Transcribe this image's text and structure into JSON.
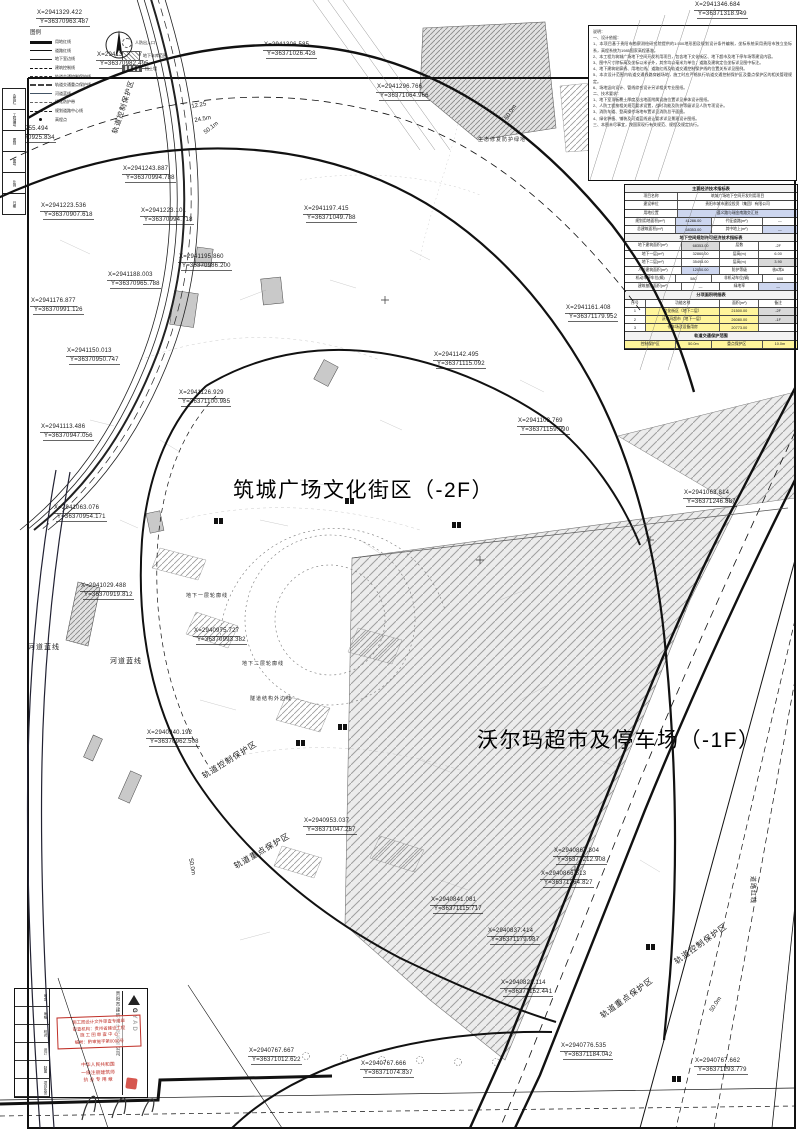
{
  "zones": {
    "zone1": "筑城广场文化街区（-2F）",
    "zone2": "沃尔玛超市及停车场（-1F）"
  },
  "compass_label": "北",
  "coord_labels": [
    {
      "x": 36,
      "y": 10,
      "l1": "X=2941329.422",
      "l2": "Y=36370963.487"
    },
    {
      "x": 96,
      "y": 52,
      "l1": "X=2941300.177",
      "l2": "Y=36370982.495"
    },
    {
      "x": 263,
      "y": 42,
      "l1": "X=2941306.585",
      "l2": "Y=36371026.428"
    },
    {
      "x": 376,
      "y": 84,
      "l1": "X=2941296.766",
      "l2": "Y=36371064.966"
    },
    {
      "x": 694,
      "y": 2,
      "l1": "X=2941346.684",
      "l2": "Y=36371318.949"
    },
    {
      "x": 2,
      "y": 126,
      "l1": "X=2941255.494",
      "l2": "Y=36370925.834"
    },
    {
      "x": 122,
      "y": 166,
      "l1": "X=2941243.887",
      "l2": "Y=36370994.788"
    },
    {
      "x": 40,
      "y": 203,
      "l1": "X=2941223.536",
      "l2": "Y=36370907.618"
    },
    {
      "x": 140,
      "y": 208,
      "l1": "X=2941223.101",
      "l2": "Y=36370994.718"
    },
    {
      "x": 303,
      "y": 206,
      "l1": "X=2941197.415",
      "l2": "Y=36371049.788"
    },
    {
      "x": 178,
      "y": 254,
      "l1": "X=2941195.860",
      "l2": "Y=36370986.200"
    },
    {
      "x": 107,
      "y": 272,
      "l1": "X=2941188.003",
      "l2": "Y=36370965.788"
    },
    {
      "x": 30,
      "y": 298,
      "l1": "X=2941176.877",
      "l2": "Y=36370991.126"
    },
    {
      "x": 66,
      "y": 348,
      "l1": "X=2941150.013",
      "l2": "Y=36370950.747"
    },
    {
      "x": 433,
      "y": 352,
      "l1": "X=2941142.495",
      "l2": "Y=36371115.092"
    },
    {
      "x": 178,
      "y": 390,
      "l1": "X=2941126.929",
      "l2": "Y=36371100.985"
    },
    {
      "x": 40,
      "y": 424,
      "l1": "X=2941113.486",
      "l2": "Y=36370947.056"
    },
    {
      "x": 565,
      "y": 305,
      "l1": "X=2941161.408",
      "l2": "Y=36371179.952"
    },
    {
      "x": 517,
      "y": 418,
      "l1": "X=2941103.769",
      "l2": "Y=36371159.990"
    },
    {
      "x": 683,
      "y": 490,
      "l1": "X=2941063.814",
      "l2": "Y=36371246.887"
    },
    {
      "x": 53,
      "y": 505,
      "l1": "X=2941063.076",
      "l2": "Y=36370954.171"
    },
    {
      "x": 80,
      "y": 583,
      "l1": "X=2941029.488",
      "l2": "Y=36370919.812"
    },
    {
      "x": 193,
      "y": 628,
      "l1": "X=2940975.727",
      "l2": "Y=36370993.382"
    },
    {
      "x": 146,
      "y": 730,
      "l1": "X=2940940.192",
      "l2": "Y=36370962.508"
    },
    {
      "x": 303,
      "y": 818,
      "l1": "X=2940953.037",
      "l2": "Y=36371047.257"
    },
    {
      "x": 553,
      "y": 848,
      "l1": "X=2940867.804",
      "l2": "Y=36371212.908"
    },
    {
      "x": 540,
      "y": 871,
      "l1": "X=2940866.513",
      "l2": "Y=36371264.827"
    },
    {
      "x": 430,
      "y": 897,
      "l1": "X=2940841.081",
      "l2": "Y=36371115.717"
    },
    {
      "x": 487,
      "y": 928,
      "l1": "X=2940837.414",
      "l2": "Y=36371179.987"
    },
    {
      "x": 500,
      "y": 980,
      "l1": "X=2940822.114",
      "l2": "Y=36371152.441"
    },
    {
      "x": 248,
      "y": 1048,
      "l1": "X=2940767.667",
      "l2": "Y=36371012.622"
    },
    {
      "x": 360,
      "y": 1061,
      "l1": "X=2940767.666",
      "l2": "Y=36371074.837"
    },
    {
      "x": 560,
      "y": 1043,
      "l1": "X=2940776.535",
      "l2": "Y=36371184.042"
    },
    {
      "x": 694,
      "y": 1058,
      "l1": "X=2940767.662",
      "l2": "Y=36371293.779"
    }
  ],
  "dim_labels": [
    {
      "t": "12.25",
      "x": 191,
      "y": 104,
      "rot": -10
    },
    {
      "t": "24.5m",
      "x": 194,
      "y": 118,
      "rot": -10
    },
    {
      "t": "50.1m",
      "x": 203,
      "y": 131,
      "rot": -38
    },
    {
      "t": "50.0m",
      "x": 504,
      "y": 118,
      "rot": -57
    },
    {
      "t": "50.0m",
      "x": 709,
      "y": 1010,
      "rot": -57
    },
    {
      "t": "50.0m",
      "x": 193,
      "y": 858,
      "rot": 80
    }
  ],
  "area_labels": [
    {
      "t": "轨道控制保护区",
      "x": 110,
      "y": 132,
      "rot": -72,
      "size": 7
    },
    {
      "t": "轨道控制保护区",
      "x": 200,
      "y": 772,
      "rot": -32
    },
    {
      "t": "轨道重点保护区",
      "x": 232,
      "y": 862,
      "rot": -30
    },
    {
      "t": "轨道控制保护区",
      "x": 672,
      "y": 958,
      "rot": -36
    },
    {
      "t": "轨道重点保护区",
      "x": 598,
      "y": 1012,
      "rot": -36
    },
    {
      "t": "河道蓝线",
      "x": 28,
      "y": 642,
      "size": 7
    },
    {
      "t": "河道蓝线",
      "x": 110,
      "y": 656,
      "size": 7
    },
    {
      "t": "地下一层轮廓线",
      "x": 186,
      "y": 592,
      "size": 5
    },
    {
      "t": "地下二层轮廓线",
      "x": 242,
      "y": 660,
      "size": 5
    },
    {
      "t": "隧道结构外边线",
      "x": 250,
      "y": 695,
      "size": 5
    },
    {
      "t": "生态修复防护绿地",
      "x": 478,
      "y": 136,
      "size": 5
    },
    {
      "t": "道路红线",
      "x": 758,
      "y": 876,
      "rot": 90,
      "size": 6
    }
  ],
  "legend": {
    "title": "图例",
    "items": [
      {
        "label": "用地红线",
        "kind": "thick"
      },
      {
        "label": "道路红线",
        "kind": "thin"
      },
      {
        "label": "地下室边线",
        "kind": "med"
      },
      {
        "label": "建筑控制线",
        "kind": "dash"
      },
      {
        "label": "轨道交通控制保护线",
        "kind": "dashdot"
      },
      {
        "label": "轨道交通重点保护线",
        "kind": "dashdot2"
      },
      {
        "label": "河道蓝线",
        "kind": "blue"
      },
      {
        "label": "绿化防护带",
        "kind": "dash2"
      },
      {
        "label": "规划道路中心线",
        "kind": "center"
      },
      {
        "label": "高程点",
        "kind": "dot"
      }
    ],
    "samples": [
      {
        "label": "人防出入口",
        "kind": "circle"
      },
      {
        "label": "地下车库范围",
        "kind": "hatch"
      },
      {
        "label": "挡土墙",
        "kind": "bar"
      }
    ]
  },
  "margin_labels": [
    "会签栏",
    "工程编号",
    "图别",
    "图号",
    "比例",
    "日期"
  ],
  "notes": {
    "lines": [
      "说明：",
      "一、设计依据：",
      "1、本项目基于贵阳市勘察测绘研究院提供的1:500地形图及规划设计条件编制，坐标系统采用贵阳市独立坐标系，高程系统为1985国家高程基准。",
      "2、本工程为筑城广场地下空间开发利用项目，包含地下文化街区、地下超市及地下停车场等建设内容。",
      "3、图中尺寸除标高及坐标以米计外，其余均以毫米为单位；道路及建筑定位坐标详见图中标注。",
      "4、地下建筑轮廓线、用地红线、道路红线及轨道交通控制保护线的位置关系详见图例。",
      "5、本次设计范围内轨道交通线路穿越场地，施工时应严格执行轨道交通控制保护区及重点保护区的相关管理规定。",
      "6、场地竖向设计、管线综合设计另详相关专业图纸。",
      "二、技术要求：",
      "1、地下室顶板覆土厚度及出地面附属设施位置详见单体设计图纸。",
      "2、人防工程按相关规范要求设置，战时功能及防护等级详见人防专项设计。",
      "3、消防车道、登高操作场地布置详见消防总平面图。",
      "4、绿化种植、铺装及河道蓝线退让要求详见景观设计图纸。",
      "三、本图未尽事宜，按国家现行有关规范、规程及规定执行。"
    ]
  },
  "table": {
    "rows": [
      {
        "h": "主要经济技术指标表"
      },
      {
        "cells": [
          {
            "t": "项目名称",
            "w": 3
          },
          {
            "t": "筑城广场地下空间开发利用项目",
            "w": 7
          }
        ]
      },
      {
        "cells": [
          {
            "t": "建设单位",
            "w": 3
          },
          {
            "t": "贵阳市城市建设投资（集团）有限公司",
            "w": 7
          }
        ]
      },
      {
        "cells": [
          {
            "t": "用地位置",
            "w": 3
          },
          {
            "t": "遵义路与瑞金南路交汇处",
            "w": 7,
            "bg": "#cdd6ef"
          }
        ]
      },
      {
        "cells": [
          {
            "t": "规划用地面积(m²)",
            "w": 3
          },
          {
            "t": "41286.00",
            "w": 2,
            "bg": "#cdd6ef"
          },
          {
            "t": "代征道路(m²)",
            "w": 3
          },
          {
            "t": "—",
            "w": 2
          }
        ]
      },
      {
        "cells": [
          {
            "t": "总建筑面积(m²)",
            "w": 3
          },
          {
            "t": "68353.00",
            "w": 2,
            "bg": "#cdd6ef"
          },
          {
            "t": "其中地上(m²)",
            "w": 3
          },
          {
            "t": "—",
            "w": 2,
            "bg": "#cdd6ef"
          }
        ]
      },
      {
        "h": "地下空间规划许可经济技术指标表"
      },
      {
        "cells": [
          {
            "t": "地下建筑面积(m²)",
            "w": 3
          },
          {
            "t": "68353.00",
            "w": 2,
            "bg": "#d9d9d9"
          },
          {
            "t": "层数",
            "w": 2
          },
          {
            "t": "-2F",
            "w": 2
          }
        ]
      },
      {
        "cells": [
          {
            "t": "地下一层(m²)",
            "w": 3
          },
          {
            "t": "32860.00",
            "w": 2
          },
          {
            "t": "层高(m)",
            "w": 2
          },
          {
            "t": "6.00",
            "w": 2
          }
        ]
      },
      {
        "cells": [
          {
            "t": "地下二层(m²)",
            "w": 3
          },
          {
            "t": "35493.00",
            "w": 2
          },
          {
            "t": "层高(m)",
            "w": 2
          },
          {
            "t": "3.90",
            "w": 2,
            "bg": "#d9d9d9"
          }
        ]
      },
      {
        "cells": [
          {
            "t": "人防建筑面积(m²)",
            "w": 3
          },
          {
            "t": "12000.00",
            "w": 2,
            "bg": "#cdd6ef"
          },
          {
            "t": "防护等级",
            "w": 2
          },
          {
            "t": "核6常6",
            "w": 2
          }
        ]
      },
      {
        "cells": [
          {
            "t": "机动车停车位(辆)",
            "w": 3
          },
          {
            "t": "580",
            "w": 2
          },
          {
            "t": "非机动车位(辆)",
            "w": 3
          },
          {
            "t": "600",
            "w": 2
          }
        ]
      },
      {
        "cells": [
          {
            "t": "建筑基底面积(m²)",
            "w": 3
          },
          {
            "t": "—",
            "w": 2
          },
          {
            "t": "绿地率",
            "w": 2
          },
          {
            "t": "—",
            "w": 2,
            "bg": "#cdd6ef"
          }
        ]
      },
      {
        "h": "分项面积明细表"
      },
      {
        "cells": [
          {
            "t": "序号",
            "w": 1
          },
          {
            "t": "功能名称",
            "w": 4
          },
          {
            "t": "面积(m²)",
            "w": 2
          },
          {
            "t": "备注",
            "w": 2
          }
        ]
      },
      {
        "cells": [
          {
            "t": "1",
            "w": 1
          },
          {
            "t": "文化街区（地下二层）",
            "w": 4,
            "bg": "#fff59b"
          },
          {
            "t": "21500.00",
            "w": 2,
            "bg": "#fff59b"
          },
          {
            "t": "-2F",
            "w": 2,
            "bg": "#d9d9d9"
          }
        ]
      },
      {
        "cells": [
          {
            "t": "2",
            "w": 1
          },
          {
            "t": "沃尔玛超市（地下一层）",
            "w": 4,
            "bg": "#fff59b"
          },
          {
            "t": "26080.00",
            "w": 2,
            "bg": "#fff59b"
          },
          {
            "t": "-1F",
            "w": 2,
            "bg": "#d9d9d9"
          }
        ]
      },
      {
        "cells": [
          {
            "t": "3",
            "w": 1
          },
          {
            "t": "停车场及设备用房",
            "w": 4,
            "bg": "#fff59b"
          },
          {
            "t": "20773.00",
            "w": 2,
            "bg": "#fff59b"
          },
          {
            "t": "",
            "w": 2
          }
        ]
      },
      {
        "h": "轨道交通保护范围"
      },
      {
        "cells": [
          {
            "t": "控制保护区",
            "w": 3,
            "bg": "#fff59b"
          },
          {
            "t": "50.0m",
            "w": 2,
            "bg": "#fff59b"
          },
          {
            "t": "重点保护区",
            "w": 3,
            "bg": "#fff59b"
          },
          {
            "t": "10.0m",
            "w": 2,
            "bg": "#fff59b"
          }
        ]
      }
    ]
  },
  "titleblock": {
    "logo": "GYAD",
    "company": "贵阳市建筑设计院有限公司",
    "cells": [
      "审定",
      "审核",
      "校对",
      "设计",
      "制图",
      "项目负责"
    ],
    "stamp1_lines": [
      "施工图设计文件审查专用章",
      "审查机构：贵州省建设工程",
      "施 工 图 审 查 中 心",
      "编号：黔审施字第0000号"
    ],
    "stamp2_lines": [
      "中华人民共和国",
      "一级注册建筑师",
      "执 业 专 用 章"
    ]
  }
}
